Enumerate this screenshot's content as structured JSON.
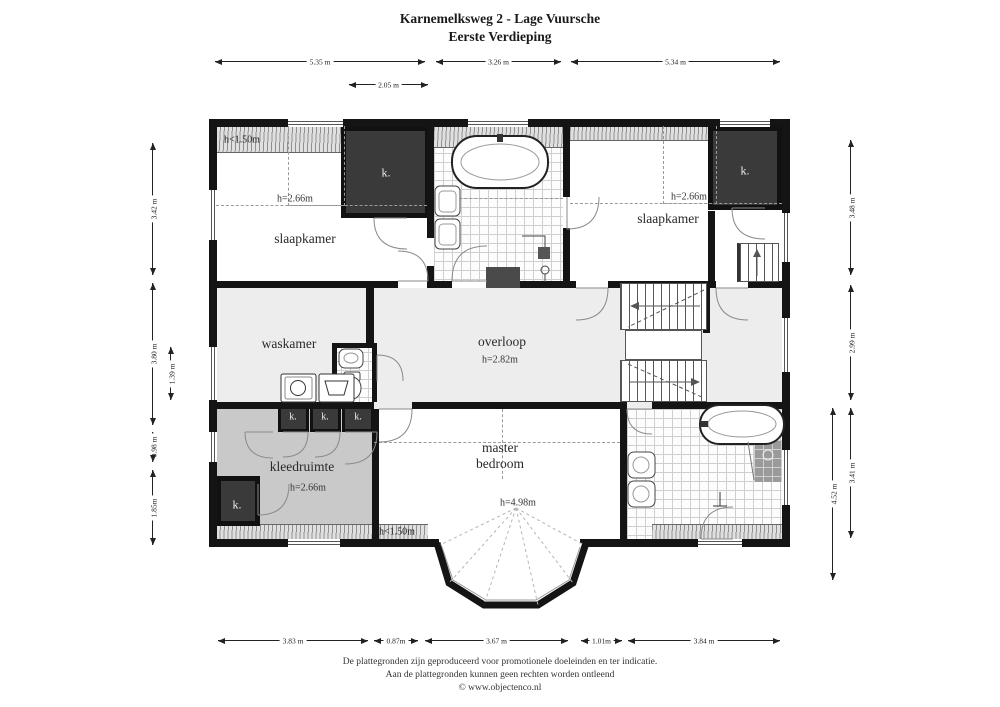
{
  "title": {
    "line1": "Karnemelksweg 2 - Lage Vuursche",
    "line2": "Eerste Verdieping"
  },
  "dimensions": {
    "top": [
      "5.35 m",
      "3.26 m",
      "5.34 m"
    ],
    "top_inner": "2.05 m",
    "bottom": [
      "3.83 m",
      "0.87m",
      "3.67 m",
      "1.01m",
      "3.84 m"
    ],
    "left": [
      "3.42 m",
      "3.80 m",
      "0.98 m",
      "1.85m"
    ],
    "left_inner": "1.39 m",
    "right": [
      "3.48 m",
      "2.99 m",
      "3.41 m"
    ],
    "right_inner": "4.52 m"
  },
  "rooms": {
    "bedroom_left": {
      "name": "slaapkamer",
      "height": "h=2.66m",
      "attic": "h<1.50m"
    },
    "bedroom_right": {
      "name": "slaapkamer",
      "height": "h=2.66m"
    },
    "laundry": {
      "name": "waskamer"
    },
    "landing": {
      "name": "overloop",
      "height": "h=2.82m"
    },
    "master": {
      "name_line1": "master",
      "name_line2": "bedroom",
      "height": "h=4.98m",
      "attic": "h<1.50m"
    },
    "dressing": {
      "name": "kleedruimte",
      "height": "h=2.66m"
    },
    "closet_label": "k."
  },
  "footer": {
    "line1": "De plattegronden zijn geproduceerd voor promotionele doeleinden en ter indicatie.",
    "line2": "Aan de plattegronden kunnen geen rechten worden ontleend",
    "line3": "© www.objectenco.nl"
  }
}
